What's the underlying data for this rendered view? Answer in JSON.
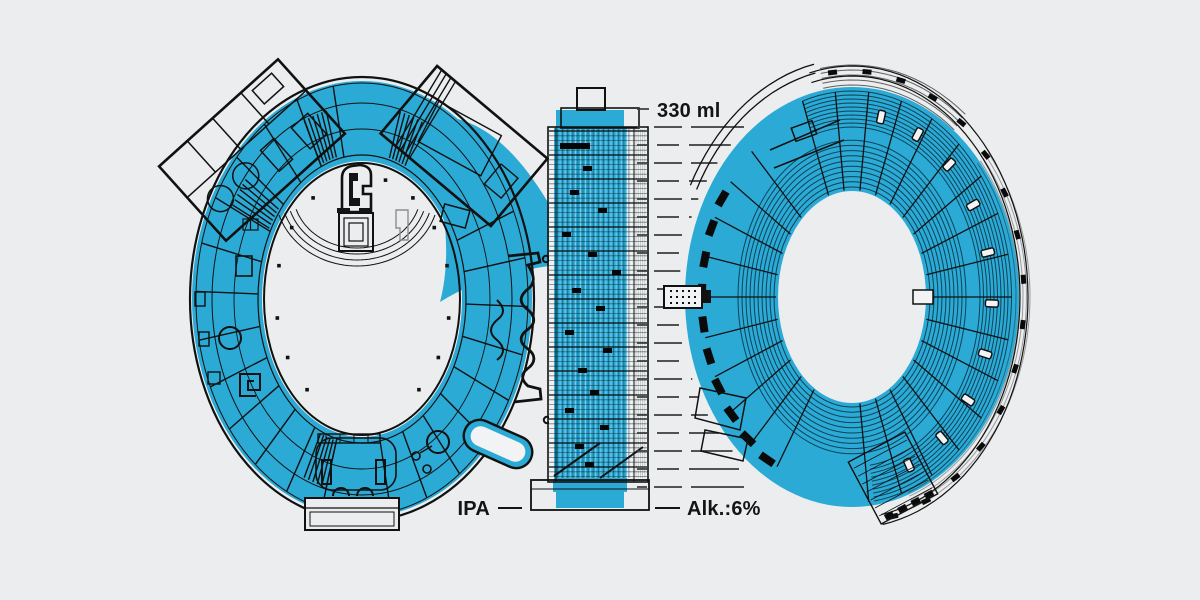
{
  "artwork": {
    "digits": [
      "0",
      "1",
      "0"
    ],
    "labels": {
      "volume": "330 ml",
      "style": "IPA",
      "alcohol": "Alk.:6%"
    },
    "colors": {
      "background": "#ECEDEE",
      "blue": "#2BAAD6",
      "ink": "#111111"
    }
  }
}
